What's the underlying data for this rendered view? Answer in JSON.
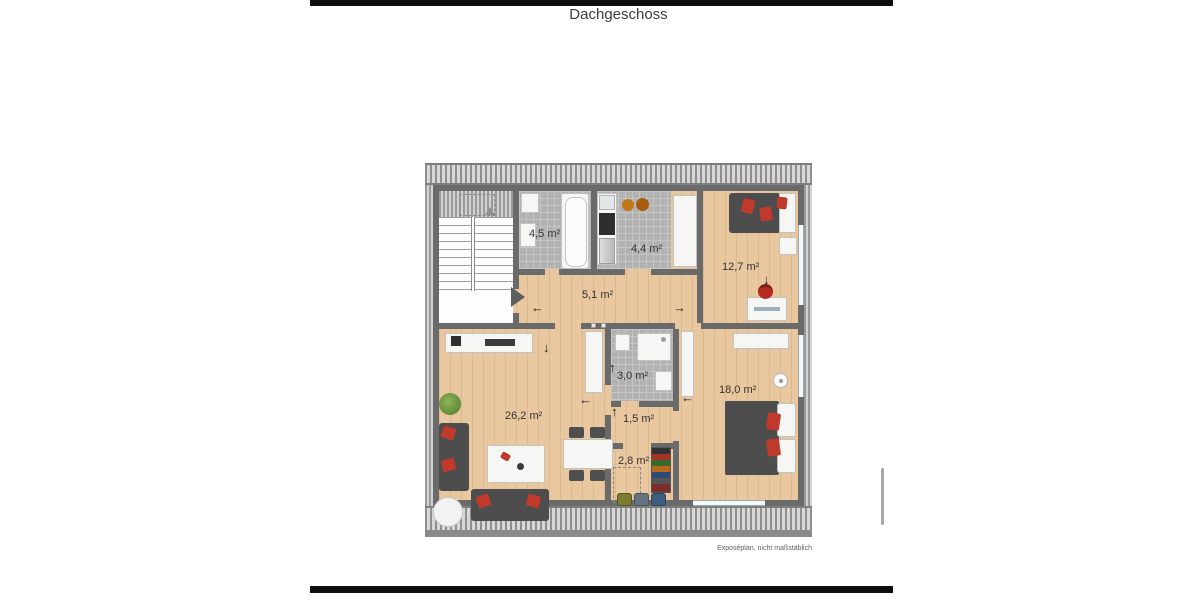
{
  "page": {
    "title": "Dachgeschoss",
    "caption": "Exposéplan, nicht maßstäblich"
  },
  "floorplan": {
    "labels": {
      "bath_small": "4,5 m²",
      "kitchen": "4,4 m²",
      "bedroom_small": "12,7 m²",
      "hallway": "5,1 m²",
      "bath": "3,0 m²",
      "living": "26,2 m²",
      "hall_small": "1,5 m²",
      "storage": "2,8 m²",
      "bedroom_large": "18,0 m²"
    },
    "colors": {
      "wall": "#6a6a6a",
      "wood_floor": "#e9c79f",
      "tile_floor": "#b2b2b2",
      "hatch": "#8f8f8f",
      "furniture_dark": "#4d4d4d",
      "accent_red": "#c0392b",
      "frame_bar": "#0f0f0f",
      "scrollbar": "#a8a8a8"
    }
  }
}
